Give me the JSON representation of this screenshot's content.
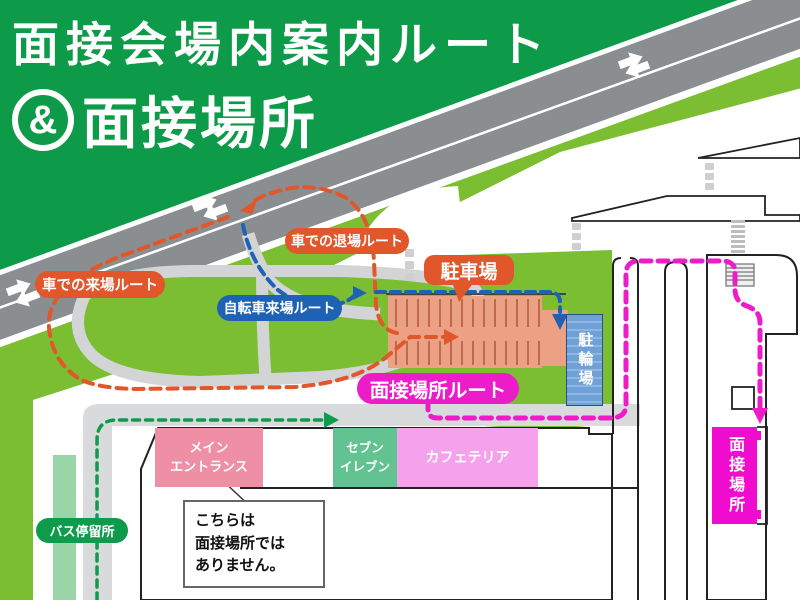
{
  "title": {
    "line1": "面接会場内案内ルート",
    "amp": "&",
    "line2": "面接場所"
  },
  "route_labels": {
    "car_arrival": "車での来場ルート",
    "car_exit": "車での退場ルート",
    "bicycle": "自転車来場ルート",
    "interview_route": "面接場所ルート"
  },
  "places": {
    "parking": "駐車場",
    "bicycle_parking": "駐輪場",
    "main_entrance": "メイン\nエントランス",
    "seven_eleven": "セブン\nイレブン",
    "cafeteria": "カフェテリア",
    "interview_room": "面接場所",
    "bus_stop": "バス停留所"
  },
  "note": {
    "text": "こちらは\n面接場所では\nありません。"
  },
  "colors": {
    "dark_green": "#0E9B49",
    "road_gray": "#8A8E91",
    "light_green": "#7CBE31",
    "pale_green": "#9BD4A6",
    "walkway_gray": "#D9DADB",
    "route_orange": "#E1562A",
    "route_blue": "#1D62B5",
    "route_magenta": "#EC1DC9",
    "route_green": "#0E9B4C",
    "parking_salmon": "#ECA184",
    "bike_blue": "#6FA1D7",
    "entrance_pink": "#EE8FA6",
    "seven_green": "#62C291",
    "cafeteria_pink": "#F6A1EB",
    "interview_magenta": "#F00CCE"
  }
}
